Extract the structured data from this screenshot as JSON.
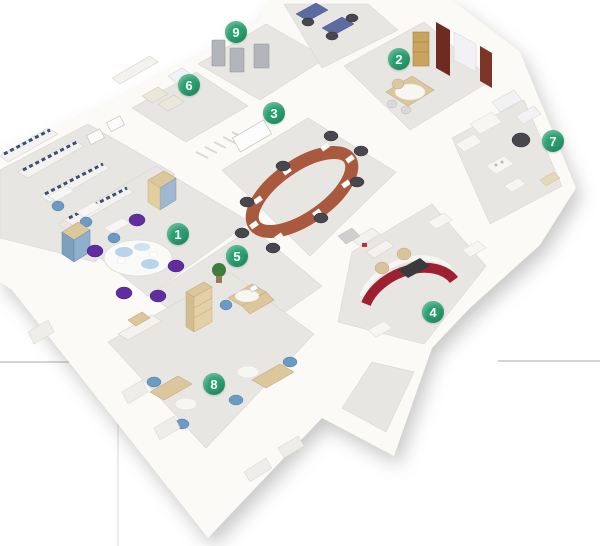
{
  "floorplan": {
    "description": "3D cutaway isometric floor plan of an office suite with nine numbered areas: meeting room with round table and purple chairs, executive office, conference room with oval wooden table, curved red reception desk, workstation corridor, archive room, lounge office, open-plan office with blue chairs, and storage room"
  },
  "markers": [
    {
      "label": "1",
      "x": 178,
      "y": 234
    },
    {
      "label": "2",
      "x": 399,
      "y": 59
    },
    {
      "label": "3",
      "x": 274,
      "y": 113
    },
    {
      "label": "4",
      "x": 433,
      "y": 312
    },
    {
      "label": "5",
      "x": 237,
      "y": 256
    },
    {
      "label": "6",
      "x": 189,
      "y": 85
    },
    {
      "label": "7",
      "x": 553,
      "y": 141
    },
    {
      "label": "8",
      "x": 214,
      "y": 384
    },
    {
      "label": "9",
      "x": 236,
      "y": 32
    }
  ],
  "colors": {
    "badge_green": "#28a06f",
    "badge_text": "#ffffff",
    "reception_red": "#9e2030",
    "conference_wood": "#a8593e",
    "chair_purple": "#5f2d9e",
    "chair_blue": "#6b9ac4",
    "chair_dark": "#47474d",
    "floor_gray": "#e8e6e2",
    "wall_white": "#fbfaf7",
    "desk_beige": "#dcc69c",
    "background_rule": "#d4d4d1"
  }
}
